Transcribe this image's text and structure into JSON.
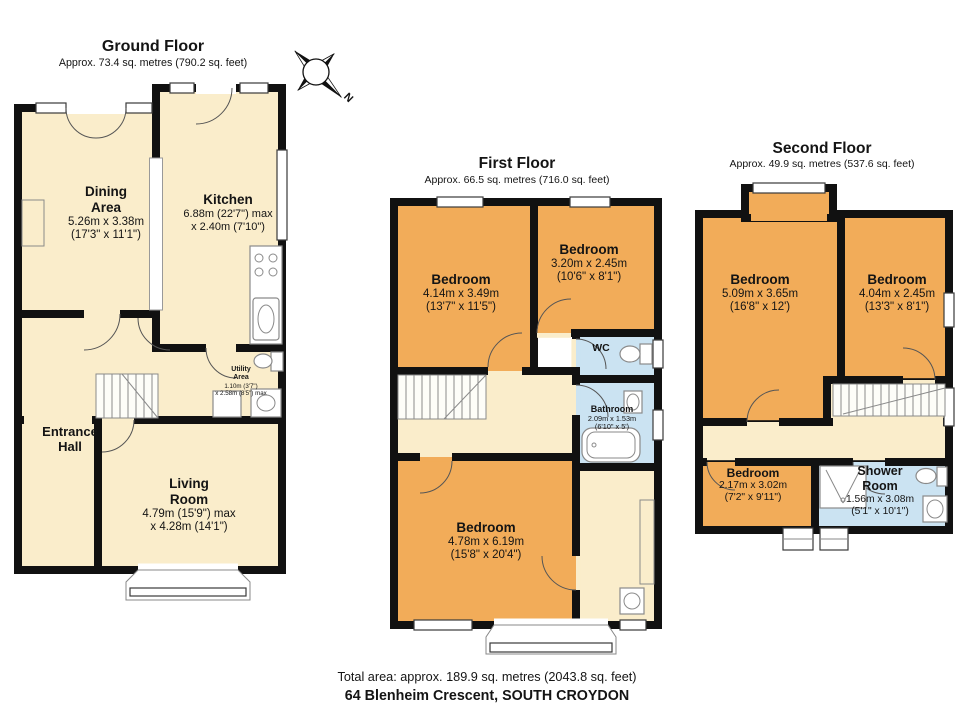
{
  "compass": {
    "label": "N"
  },
  "floors": {
    "ground": {
      "title": "Ground Floor",
      "subtitle": "Approx. 73.4 sq. metres (790.2 sq. feet)",
      "rooms": {
        "dining": {
          "line1": "Dining",
          "line2": "Area",
          "dim1": "5.26m x 3.38m",
          "dim2": "(17'3\" x 11'1\")"
        },
        "kitchen": {
          "line1": "Kitchen",
          "dim1": "6.88m (22'7\") max",
          "dim2": "x 2.40m (7'10\")"
        },
        "utility": {
          "line1": "Utility",
          "line2": "Area",
          "dim1": "1.10m (3'7\")",
          "dim2": "x 2.58m (8'5\") max"
        },
        "entrance": {
          "line1": "Entrance",
          "line2": "Hall"
        },
        "living": {
          "line1": "Living",
          "line2": "Room",
          "dim1": "4.79m (15'9\") max",
          "dim2": "x 4.28m (14'1\")"
        }
      }
    },
    "first": {
      "title": "First Floor",
      "subtitle": "Approx. 66.5 sq. metres (716.0 sq. feet)",
      "rooms": {
        "bedroom_front": {
          "line1": "Bedroom",
          "dim1": "4.14m x 3.49m",
          "dim2": "(13'7\" x 11'5\")"
        },
        "bedroom_small": {
          "line1": "Bedroom",
          "dim1": "3.20m x 2.45m",
          "dim2": "(10'6\" x 8'1\")"
        },
        "wc": {
          "line1": "WC"
        },
        "bathroom": {
          "line1": "Bathroom",
          "dim1": "2.09m x 1.53m",
          "dim2": "(6'10\" x 5')"
        },
        "bedroom_rear": {
          "line1": "Bedroom",
          "dim1": "4.78m x 6.19m",
          "dim2": "(15'8\" x 20'4\")"
        }
      }
    },
    "second": {
      "title": "Second Floor",
      "subtitle": "Approx. 49.9 sq. metres (537.6 sq. feet)",
      "rooms": {
        "bedroom_left": {
          "line1": "Bedroom",
          "dim1": "5.09m x 3.65m",
          "dim2": "(16'8\" x 12')"
        },
        "bedroom_right": {
          "line1": "Bedroom",
          "dim1": "4.04m x 2.45m",
          "dim2": "(13'3\" x 8'1\")"
        },
        "bedroom_small": {
          "line1": "Bedroom",
          "dim1": "2.17m x 3.02m",
          "dim2": "(7'2\" x 9'11\")"
        },
        "shower": {
          "line1": "Shower",
          "line2": "Room",
          "dim1": "1.56m x 3.08m",
          "dim2": "(5'1\" x 10'1\")"
        }
      }
    }
  },
  "footer": {
    "total_area": "Total area: approx. 189.9 sq. metres (2043.8 sq. feet)",
    "address": "64 Blenheim Crescent, SOUTH CROYDON"
  },
  "colors": {
    "wall": "#111111",
    "room_cream": "#FAEDCB",
    "room_orange": "#F2AC59",
    "room_blue": "#CBE3F2"
  }
}
